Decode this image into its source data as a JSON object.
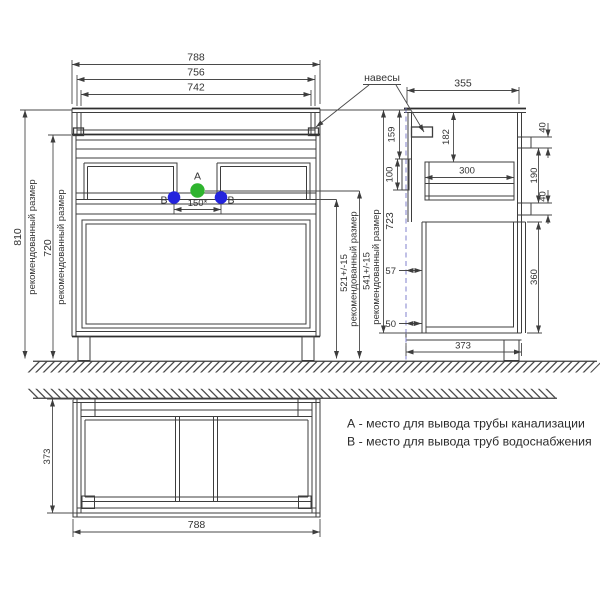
{
  "views": {
    "front": {
      "width_788": "788",
      "width_756": "756",
      "width_742": "742",
      "height_810": "810",
      "height_720": "720",
      "recommended": "рекомендованный размер",
      "spacing_150": "150*",
      "supply_521": "521+/-15",
      "drain_541": "541+/-15",
      "height_723": "723",
      "point_a": "A",
      "point_b": "B"
    },
    "side": {
      "hangers": "навесы",
      "depth_355": "355",
      "drop_159": "159",
      "bracket_100": "100",
      "top_182": "182",
      "drawer_300": "300",
      "fascia_40_top": "40",
      "gap_190": "190",
      "fascia_40_bottom": "40",
      "door_360": "360",
      "wall_gap_57": "57",
      "wall_gap_50": "50",
      "depth_373": "373"
    },
    "plan": {
      "depth_373": "373",
      "width_788": "788"
    }
  },
  "legend": {
    "note_a": "А - место для вывода трубы канализации",
    "note_b": "B - место для вывода труб водоснабжения"
  },
  "colors": {
    "line": "#3d3d3d",
    "dim": "#4a4a4a",
    "text": "#333333",
    "wall_dashed": "#8080cc",
    "point_a_fill": "#2eb42e",
    "point_b_fill": "#2424dd"
  }
}
